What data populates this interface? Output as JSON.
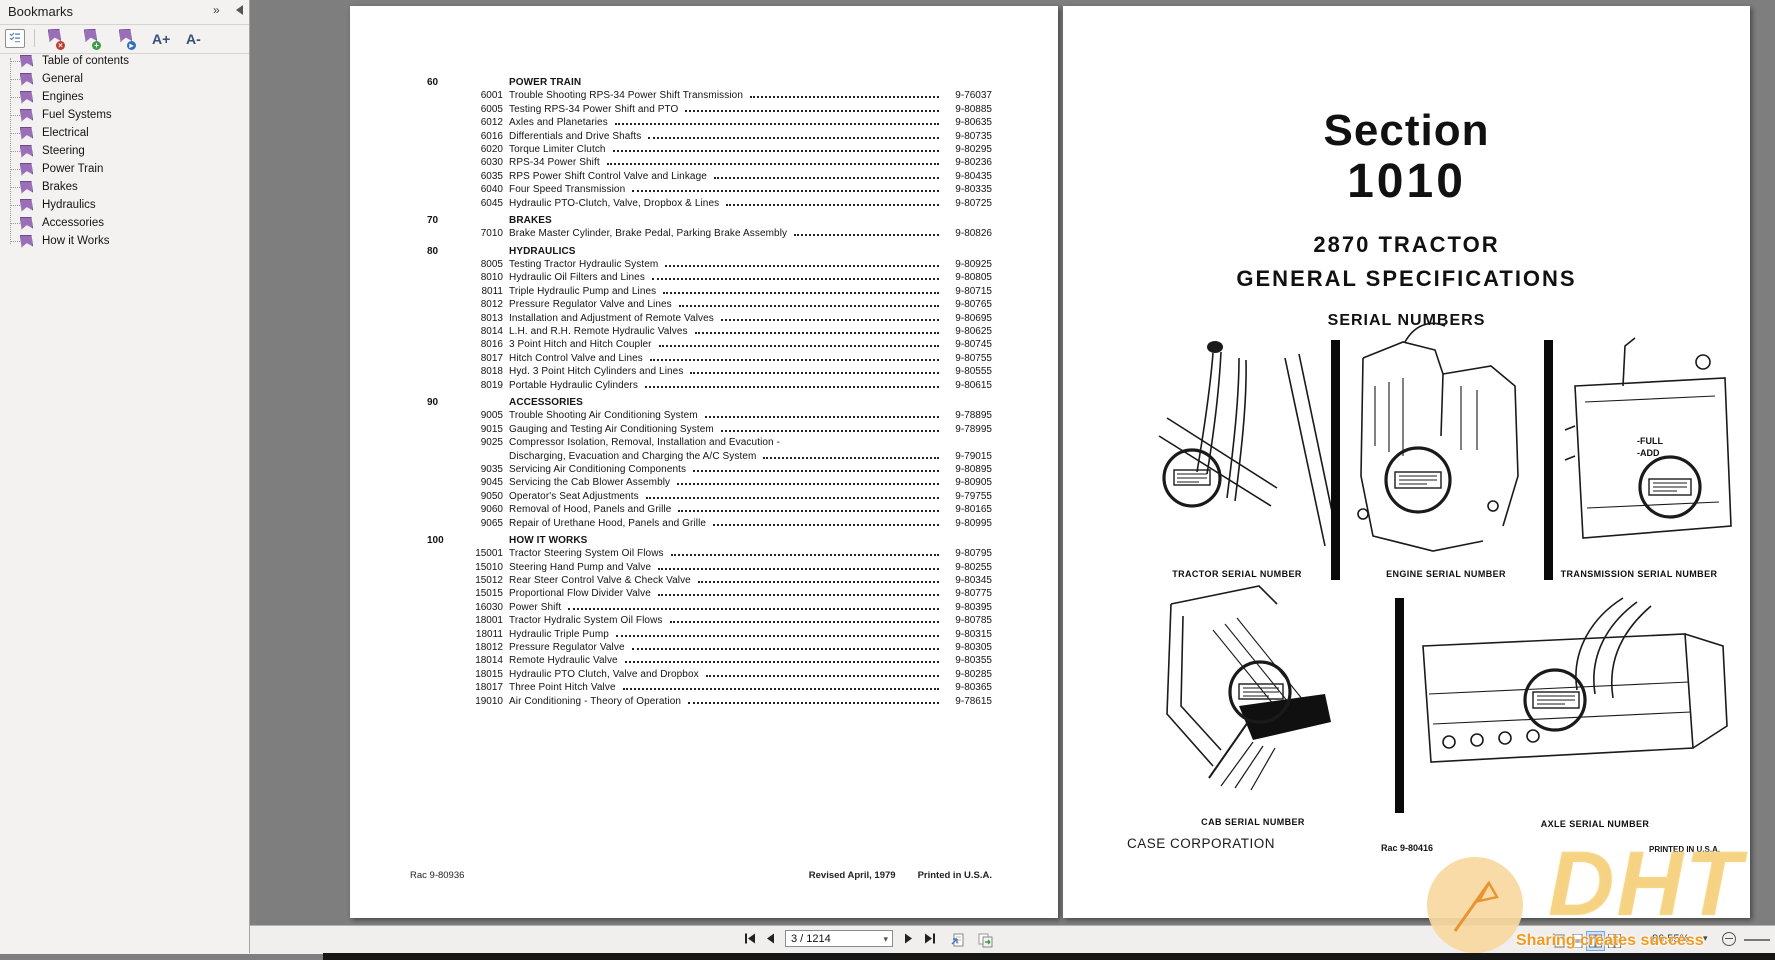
{
  "colors": {
    "bookmark_purple": "#9a6fb8",
    "watermark_orange": "#f29a1d",
    "selection_blue": "#cfe3f8",
    "page_background": "#ffffff",
    "viewer_background": "#7e7e7e"
  },
  "sidebar": {
    "title": "Bookmarks",
    "toolbar": {
      "increase_label": "A+",
      "decrease_label": "A-"
    },
    "items": [
      "Table of contents",
      "General",
      "Engines",
      "Fuel Systems",
      "Electrical",
      "Steering",
      "Power Train",
      "Brakes",
      "Hydraulics",
      "Accessories",
      "How it Works"
    ]
  },
  "toc": {
    "sections": [
      {
        "num": "60",
        "heading": "POWER TRAIN",
        "items": [
          {
            "id": "6001",
            "title": "Trouble Shooting RPS-34 Power Shift Transmission",
            "page": "9-76037"
          },
          {
            "id": "6005",
            "title": "Testing RPS-34 Power Shift and PTO",
            "page": "9-80885"
          },
          {
            "id": "6012",
            "title": "Axles and Planetaries",
            "page": "9-80635"
          },
          {
            "id": "6016",
            "title": "Differentials and Drive Shafts",
            "page": "9-80735"
          },
          {
            "id": "6020",
            "title": "Torque Limiter Clutch",
            "page": "9-80295"
          },
          {
            "id": "6030",
            "title": "RPS-34 Power Shift",
            "page": "9-80236"
          },
          {
            "id": "6035",
            "title": "RPS Power Shift Control Valve and Linkage",
            "page": "9-80435"
          },
          {
            "id": "6040",
            "title": "Four Speed Transmission",
            "page": "9-80335"
          },
          {
            "id": "6045",
            "title": "Hydraulic PTO-Clutch, Valve, Dropbox & Lines",
            "page": "9-80725"
          }
        ]
      },
      {
        "num": "70",
        "heading": "BRAKES",
        "items": [
          {
            "id": "7010",
            "title": "Brake Master Cylinder, Brake Pedal, Parking Brake Assembly",
            "page": "9-80826"
          }
        ]
      },
      {
        "num": "80",
        "heading": "HYDRAULICS",
        "items": [
          {
            "id": "8005",
            "title": "Testing Tractor Hydraulic System",
            "page": "9-80925"
          },
          {
            "id": "8010",
            "title": "Hydraulic Oil Filters and Lines",
            "page": "9-80805"
          },
          {
            "id": "8011",
            "title": "Triple Hydraulic Pump and Lines",
            "page": "9-80715"
          },
          {
            "id": "8012",
            "title": "Pressure Regulator Valve and Lines",
            "page": "9-80765"
          },
          {
            "id": "8013",
            "title": "Installation and Adjustment of Remote Valves",
            "page": "9-80695"
          },
          {
            "id": "8014",
            "title": "L.H. and R.H. Remote Hydraulic Valves",
            "page": "9-80625"
          },
          {
            "id": "8016",
            "title": "3 Point Hitch and Hitch Coupler",
            "page": "9-80745"
          },
          {
            "id": "8017",
            "title": "Hitch Control Valve and Lines",
            "page": "9-80755"
          },
          {
            "id": "8018",
            "title": "Hyd. 3 Point Hitch Cylinders and Lines",
            "page": "9-80555"
          },
          {
            "id": "8019",
            "title": "Portable Hydraulic Cylinders",
            "page": "9-80615"
          }
        ]
      },
      {
        "num": "90",
        "heading": "ACCESSORIES",
        "items": [
          {
            "id": "9005",
            "title": "Trouble Shooting Air Conditioning System",
            "page": "9-78895"
          },
          {
            "id": "9015",
            "title": "Gauging and Testing Air Conditioning System",
            "page": "9-78995"
          },
          {
            "id": "9025",
            "title": "Compressor Isolation, Removal, Installation and Evacution -",
            "title2": "Discharging, Evacuation and Charging the A/C System",
            "page": "9-79015"
          },
          {
            "id": "9035",
            "title": "Servicing Air Conditioning Components",
            "page": "9-80895"
          },
          {
            "id": "9045",
            "title": "Servicing the Cab Blower Assembly",
            "page": "9-80905"
          },
          {
            "id": "9050",
            "title": "Operator's Seat Adjustments",
            "page": "9-79755"
          },
          {
            "id": "9060",
            "title": "Removal of Hood, Panels and Grille",
            "page": "9-80165"
          },
          {
            "id": "9065",
            "title": "Repair of Urethane Hood, Panels and Grille",
            "page": "9-80995"
          }
        ]
      },
      {
        "num": "100",
        "heading": "HOW IT WORKS",
        "items": [
          {
            "id": "15001",
            "title": "Tractor Steering System Oil Flows",
            "page": "9-80795"
          },
          {
            "id": "15010",
            "title": "Steering Hand Pump and Valve",
            "page": "9-80255"
          },
          {
            "id": "15012",
            "title": "Rear Steer Control Valve & Check Valve",
            "page": "9-80345"
          },
          {
            "id": "15015",
            "title": "Proportional Flow Divider Valve",
            "page": "9-80775"
          },
          {
            "id": "16030",
            "title": "Power Shift",
            "page": "9-80395"
          },
          {
            "id": "18001",
            "title": "Tractor Hydralic System Oil Flows",
            "page": "9-80785"
          },
          {
            "id": "18011",
            "title": "Hydraulic Triple Pump",
            "page": "9-80315"
          },
          {
            "id": "18012",
            "title": "Pressure Regulator Valve",
            "page": "9-80305"
          },
          {
            "id": "18014",
            "title": "Remote Hydraulic Valve",
            "page": "9-80355"
          },
          {
            "id": "18015",
            "title": "Hydraulic PTO Clutch, Valve and Dropbox",
            "page": "9-80285"
          },
          {
            "id": "18017",
            "title": "Three Point Hitch Valve",
            "page": "9-80365"
          },
          {
            "id": "19010",
            "title": "Air Conditioning - Theory of Operation",
            "page": "9-78615"
          }
        ]
      }
    ],
    "footer": {
      "doc_code": "Rac 9-80936",
      "revised": "Revised April, 1979",
      "printed": "Printed in U.S.A."
    }
  },
  "section_page": {
    "title_word": "Section",
    "title_number": "1010",
    "model": "2870 TRACTOR",
    "subtitle": "GENERAL SPECIFICATIONS",
    "heading": "SERIAL NUMBERS",
    "labels": {
      "tractor": "TRACTOR SERIAL NUMBER",
      "engine": "ENGINE SERIAL NUMBER",
      "transmission": "TRANSMISSION SERIAL NUMBER",
      "cab": "CAB SERIAL NUMBER",
      "axle": "AXLE SERIAL NUMBER"
    },
    "dipstick": {
      "full": "-FULL",
      "add": "-ADD"
    },
    "footer": {
      "company": "CASE CORPORATION",
      "doc_code": "Rac 9-80416",
      "printed": "PRINTED IN U.S.A."
    }
  },
  "viewer_toolbar": {
    "page_field_value": "3 / 1214",
    "zoom_value": "86.55%"
  },
  "watermark": {
    "brand": "DHT",
    "slogan": "Sharing creates success"
  }
}
